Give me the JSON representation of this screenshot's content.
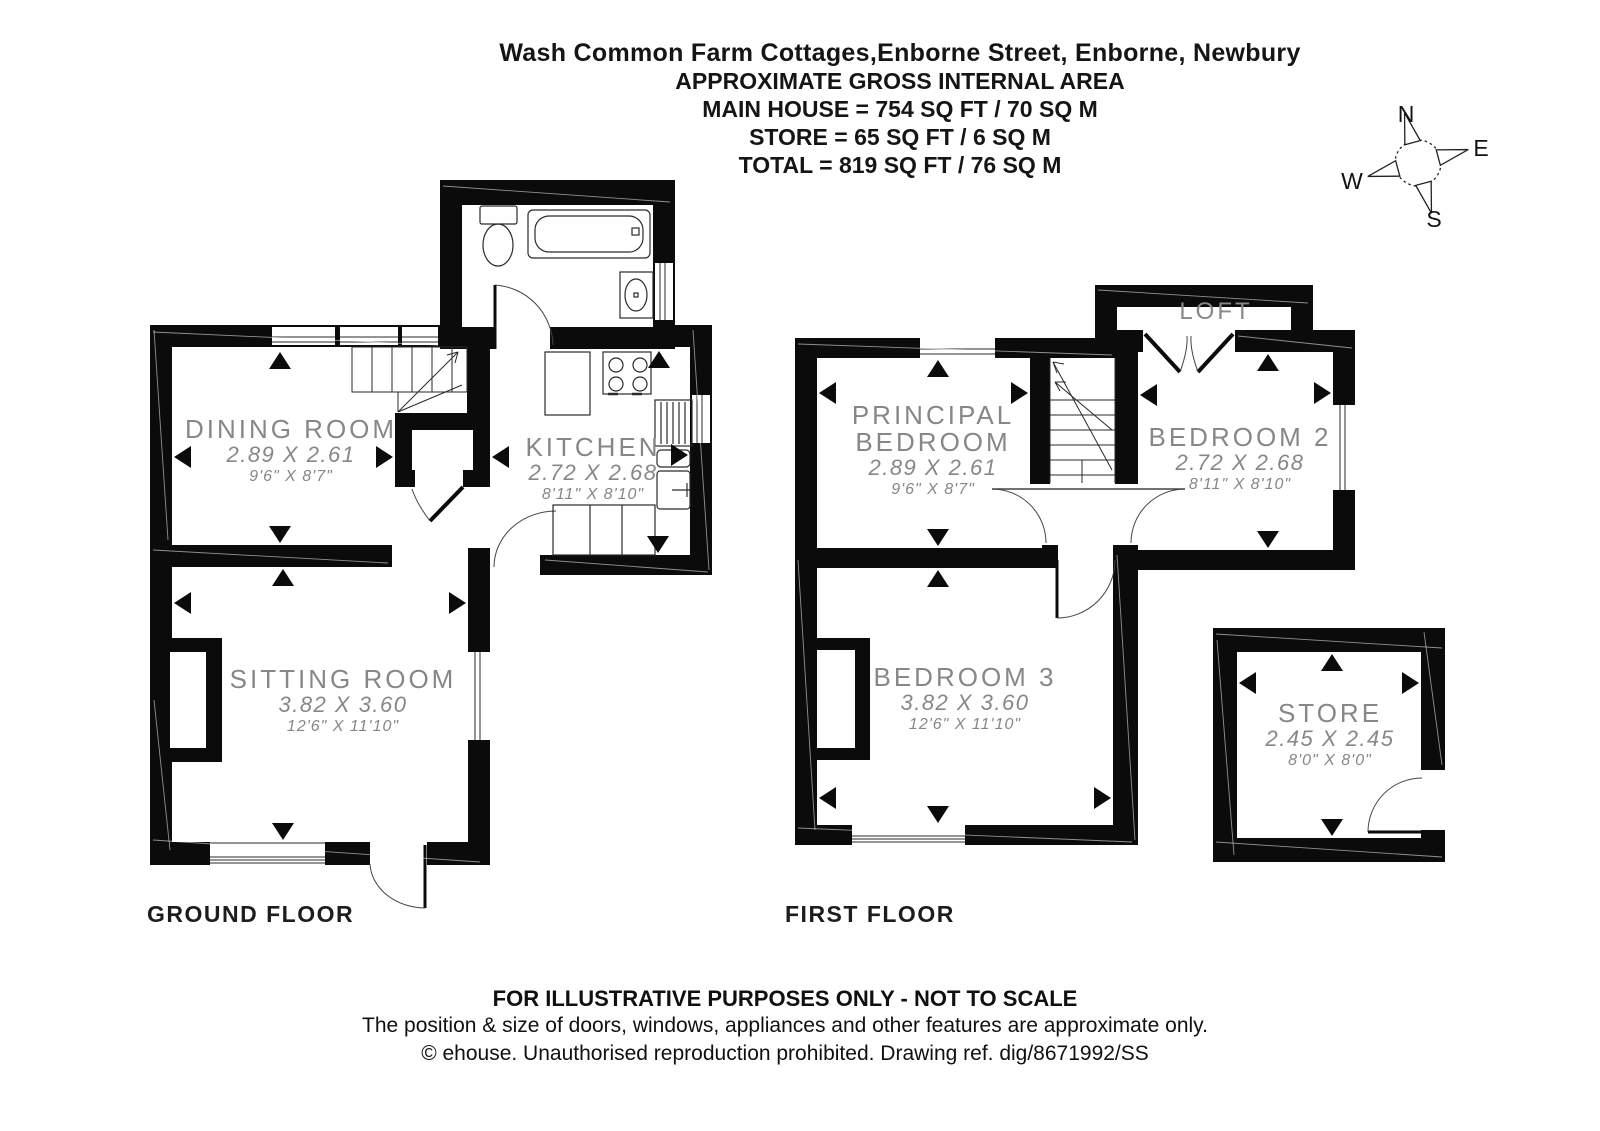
{
  "header": {
    "title": "Wash Common Farm Cottages,Enborne Street, Enborne, Newbury",
    "line1": "APPROXIMATE GROSS INTERNAL AREA",
    "line2": "MAIN HOUSE = 754 SQ FT / 70 SQ M",
    "line3": "STORE = 65 SQ FT / 6 SQ M",
    "line4": "TOTAL = 819 SQ FT / 76 SQ M"
  },
  "compass": {
    "n": "N",
    "e": "E",
    "s": "S",
    "w": "W"
  },
  "floors": {
    "ground": {
      "label": "GROUND FLOOR",
      "rooms": {
        "dining": {
          "name": "DINING ROOM",
          "metric": "2.89 X 2.61",
          "imperial": "9'6\" X 8'7\""
        },
        "kitchen": {
          "name": "KITCHEN",
          "metric": "2.72 X 2.68",
          "imperial": "8'11\" X 8'10\""
        },
        "sitting": {
          "name": "SITTING ROOM",
          "metric": "3.82 X 3.60",
          "imperial": "12'6\" X 11'10\""
        }
      }
    },
    "first": {
      "label": "FIRST FLOOR",
      "rooms": {
        "principal": {
          "name_line1": "PRINCIPAL",
          "name_line2": "BEDROOM",
          "metric": "2.89 X 2.61",
          "imperial": "9'6\" X 8'7\""
        },
        "bedroom2": {
          "name": "BEDROOM 2",
          "metric": "2.72 X 2.68",
          "imperial": "8'11\" X 8'10\""
        },
        "bedroom3": {
          "name": "BEDROOM 3",
          "metric": "3.82 X 3.60",
          "imperial": "12'6\" X 11'10\""
        },
        "loft": {
          "name": "LOFT"
        },
        "store": {
          "name": "STORE",
          "metric": "2.45 X 2.45",
          "imperial": "8'0\" X 8'0\""
        }
      }
    }
  },
  "footer": {
    "line1": "FOR ILLUSTRATIVE PURPOSES ONLY - NOT TO SCALE",
    "line2": "The position & size of doors, windows, appliances and other features are approximate only.",
    "line3": "© ehouse. Unauthorised reproduction prohibited. Drawing ref. dig/8671992/SS"
  },
  "colors": {
    "wall": "#0b0b0b",
    "label_gray": "#878787",
    "line": "#222222"
  }
}
